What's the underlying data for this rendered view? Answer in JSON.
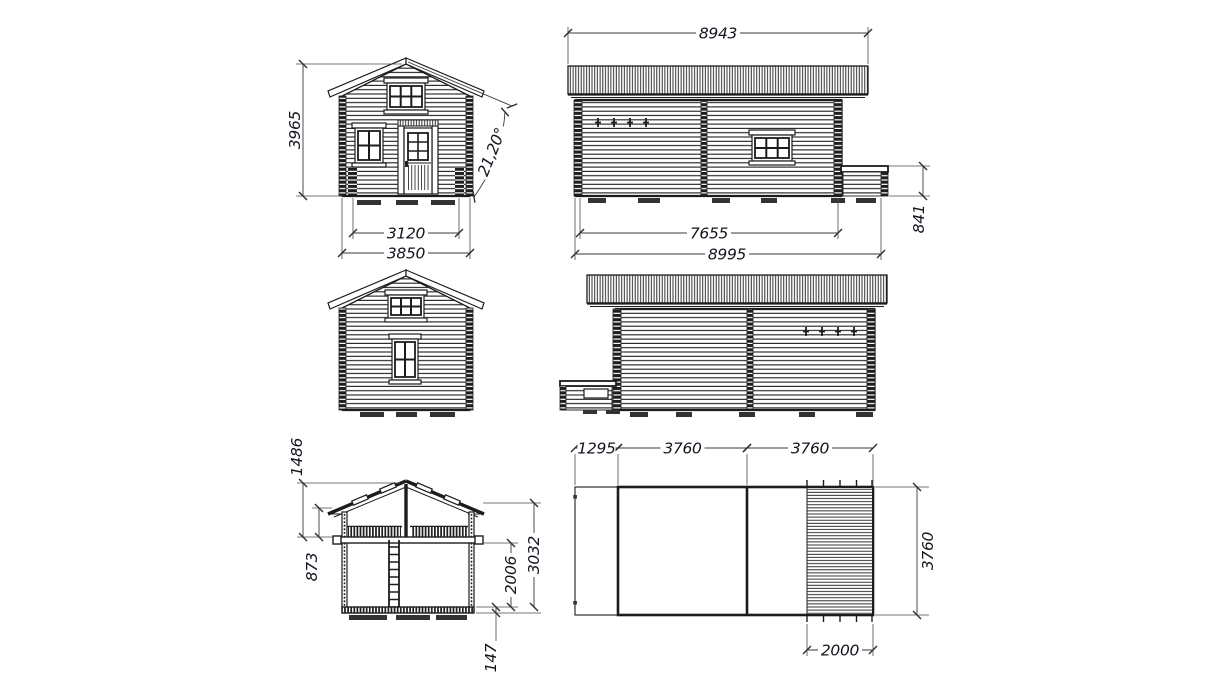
{
  "drawing": {
    "background": "#ffffff",
    "ink_color": "#1c1c1c",
    "dim_text_color": "#14141f",
    "views": {
      "front_elevation": {
        "dims": {
          "total_height": "3965",
          "roof_pitch": "21,20°",
          "inner_width": "3120",
          "overall_width": "3850"
        }
      },
      "right_side_elevation": {
        "dims": {
          "roof_length": "8943",
          "wall_length": "7655",
          "overall_length": "8995",
          "terrace_height": "841"
        }
      },
      "cross_section": {
        "dims": {
          "ridge_to_loft_floor": "1486",
          "loft_side_height": "873",
          "ground_floor_height": "2006",
          "total_inner_height": "3032",
          "floor_thickness": "147"
        }
      },
      "floor_plan": {
        "dims": {
          "porch_depth": "1295",
          "room_1_length": "3760",
          "room_2_length": "3760",
          "plan_width": "3760",
          "deck_depth": "2000"
        }
      }
    }
  }
}
